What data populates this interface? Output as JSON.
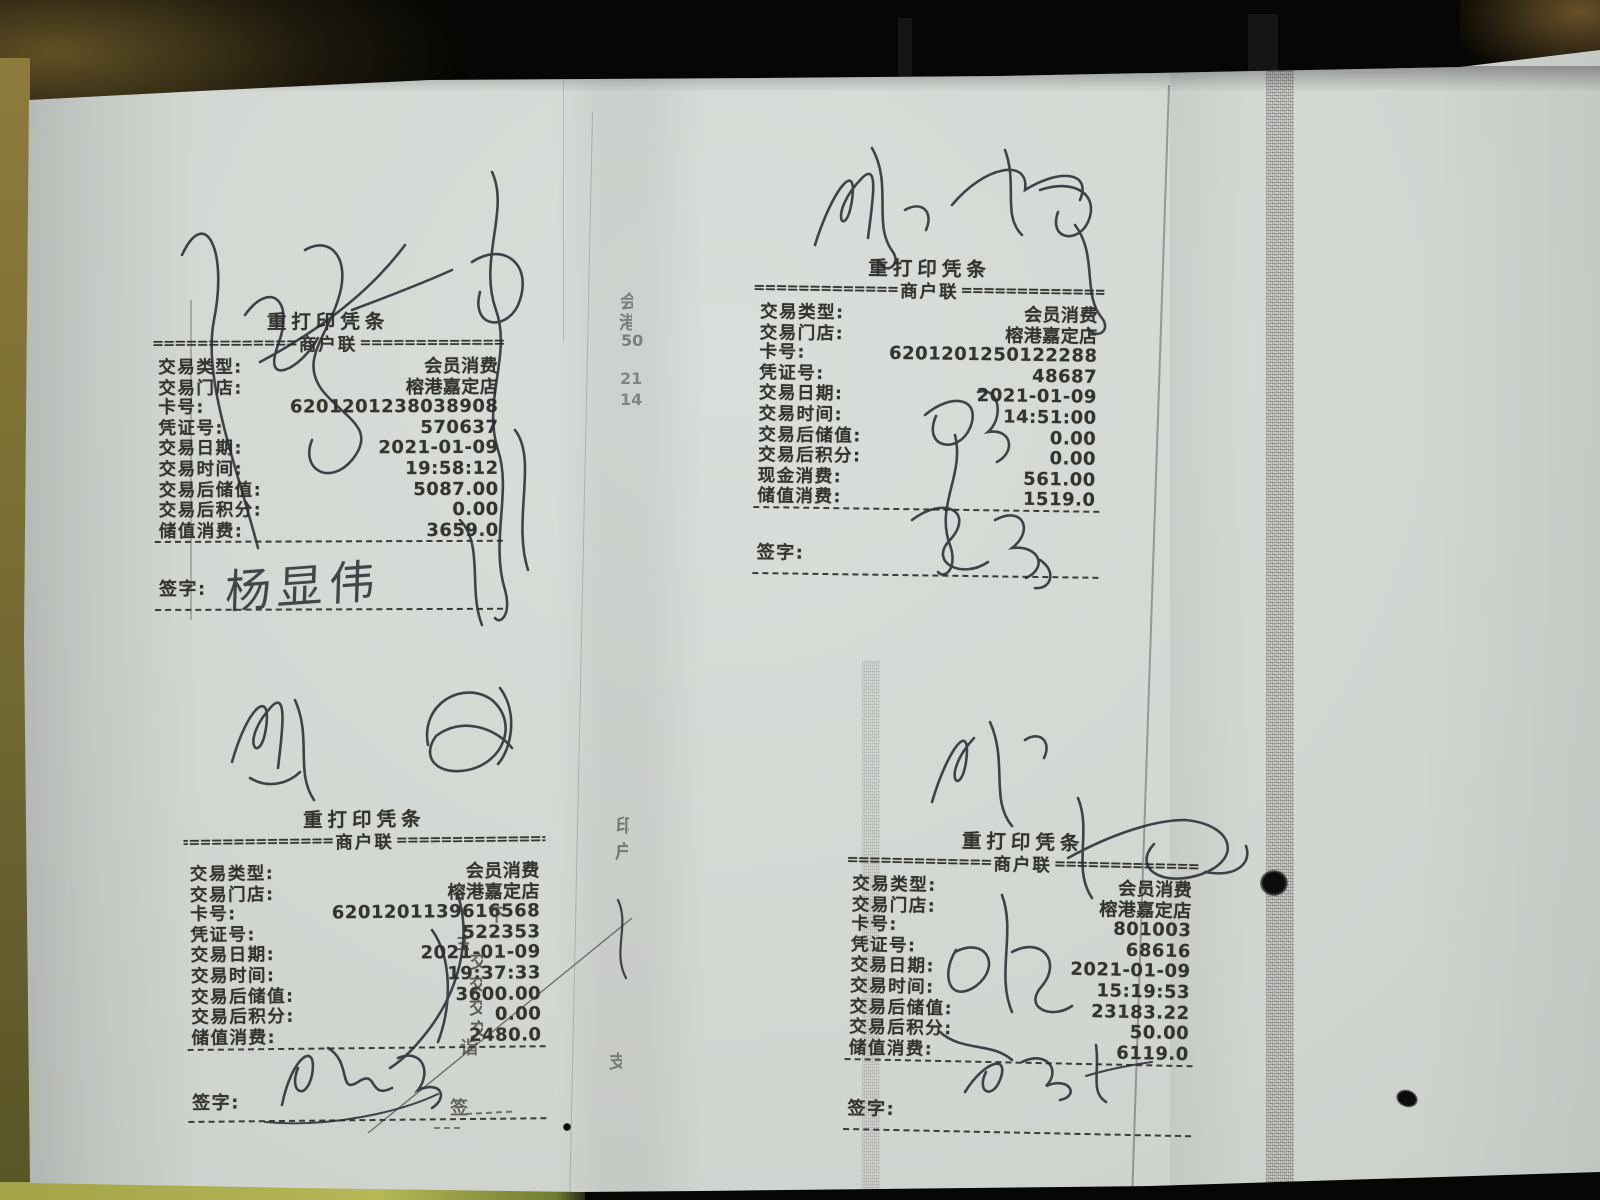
{
  "receipts": [
    {
      "position": "top-left",
      "title": "重打印凭条",
      "copy_label": "商户联",
      "dashes_left": "====================",
      "dashes_right": "====================",
      "rows": [
        {
          "label": "交易类型:",
          "value": "会员消费"
        },
        {
          "label": "交易门店:",
          "value": "榕港嘉定店"
        },
        {
          "label": "卡号:",
          "value": "6201201238038908"
        },
        {
          "label": "凭证号:",
          "value": "570637"
        },
        {
          "label": "交易日期:",
          "value": "2021-01-09"
        },
        {
          "label": "交易时间:",
          "value": "19:58:12"
        },
        {
          "label": "交易后储值:",
          "value": "5087.00"
        },
        {
          "label": "交易后积分:",
          "value": "0.00"
        },
        {
          "label": "储值消费:",
          "value": "3659.0"
        }
      ],
      "sign_label": "签字:",
      "handwritten_name": "杨显伟"
    },
    {
      "position": "top-right",
      "title": "重打印凭条",
      "copy_label": "商户联",
      "dashes_left": "====================",
      "dashes_right": "====================",
      "rows": [
        {
          "label": "交易类型:",
          "value": "会员消费"
        },
        {
          "label": "交易门店:",
          "value": "榕港嘉定店"
        },
        {
          "label": "卡号:",
          "value": "6201201250122288"
        },
        {
          "label": "凭证号:",
          "value": "48687"
        },
        {
          "label": "交易日期:",
          "value": "2021-01-09"
        },
        {
          "label": "交易时间:",
          "value": "14:51:00"
        },
        {
          "label": "交易后储值:",
          "value": "0.00"
        },
        {
          "label": "交易后积分:",
          "value": "0.00"
        },
        {
          "label": "现金消费:",
          "value": "561.00"
        },
        {
          "label": "储值消费:",
          "value": "1519.0"
        }
      ],
      "sign_label": "签字:",
      "handwritten_name": ""
    },
    {
      "position": "bottom-left",
      "title": "重打印凭条",
      "copy_label": "商户联",
      "dashes_left": "====================",
      "dashes_right": "====================",
      "rows": [
        {
          "label": "交易类型:",
          "value": "会员消费"
        },
        {
          "label": "交易门店:",
          "value": "榕港嘉定店"
        },
        {
          "label": "卡号:",
          "value": "6201201139616568"
        },
        {
          "label": "凭证号:",
          "value": "522353"
        },
        {
          "label": "交易日期:",
          "value": "2021-01-09"
        },
        {
          "label": "交易时间:",
          "value": "19:37:33"
        },
        {
          "label": "交易后储值:",
          "value": "3600.00"
        },
        {
          "label": "交易后积分:",
          "value": "0.00"
        },
        {
          "label": "储值消费:",
          "value": "2480.0"
        }
      ],
      "sign_label": "签字:",
      "handwritten_name": ""
    },
    {
      "position": "bottom-right",
      "title": "重打印凭条",
      "copy_label": "商户联",
      "dashes_left": "====================",
      "dashes_right": "====================",
      "rows": [
        {
          "label": "交易类型:",
          "value": "会员消费"
        },
        {
          "label": "交易门店:",
          "value": "榕港嘉定店"
        },
        {
          "label": "卡号:",
          "value": "801003"
        },
        {
          "label": "凭证号:",
          "value": "68616"
        },
        {
          "label": "交易日期:",
          "value": "2021-01-09"
        },
        {
          "label": "交易时间:",
          "value": "15:19:53"
        },
        {
          "label": "交易后储值:",
          "value": "23183.22"
        },
        {
          "label": "交易后积分:",
          "value": "50.00"
        },
        {
          "label": "储值消费:",
          "value": "6119.0"
        }
      ],
      "sign_label": "签字:",
      "handwritten_name": ""
    }
  ],
  "fragments": [
    {
      "text": "会"
    },
    {
      "text": "港"
    },
    {
      "text": "50"
    },
    {
      "text": "21"
    },
    {
      "text": "14"
    },
    {
      "text": "印"
    },
    {
      "text": "户"
    },
    {
      "text": "支"
    },
    {
      "text": "主"
    },
    {
      "text": "交"
    },
    {
      "text": "交"
    },
    {
      "text": "交"
    },
    {
      "text": "交"
    },
    {
      "text": "诣"
    },
    {
      "text": "下"
    },
    {
      "text": "签"
    }
  ],
  "colors": {
    "paper": "#d3d7d2",
    "print_ink": "#34342e",
    "pen_ink": "#2b2d36",
    "table_olive": "#8d7b3b",
    "table_yellow": "#b5b855",
    "background": "#060604"
  }
}
